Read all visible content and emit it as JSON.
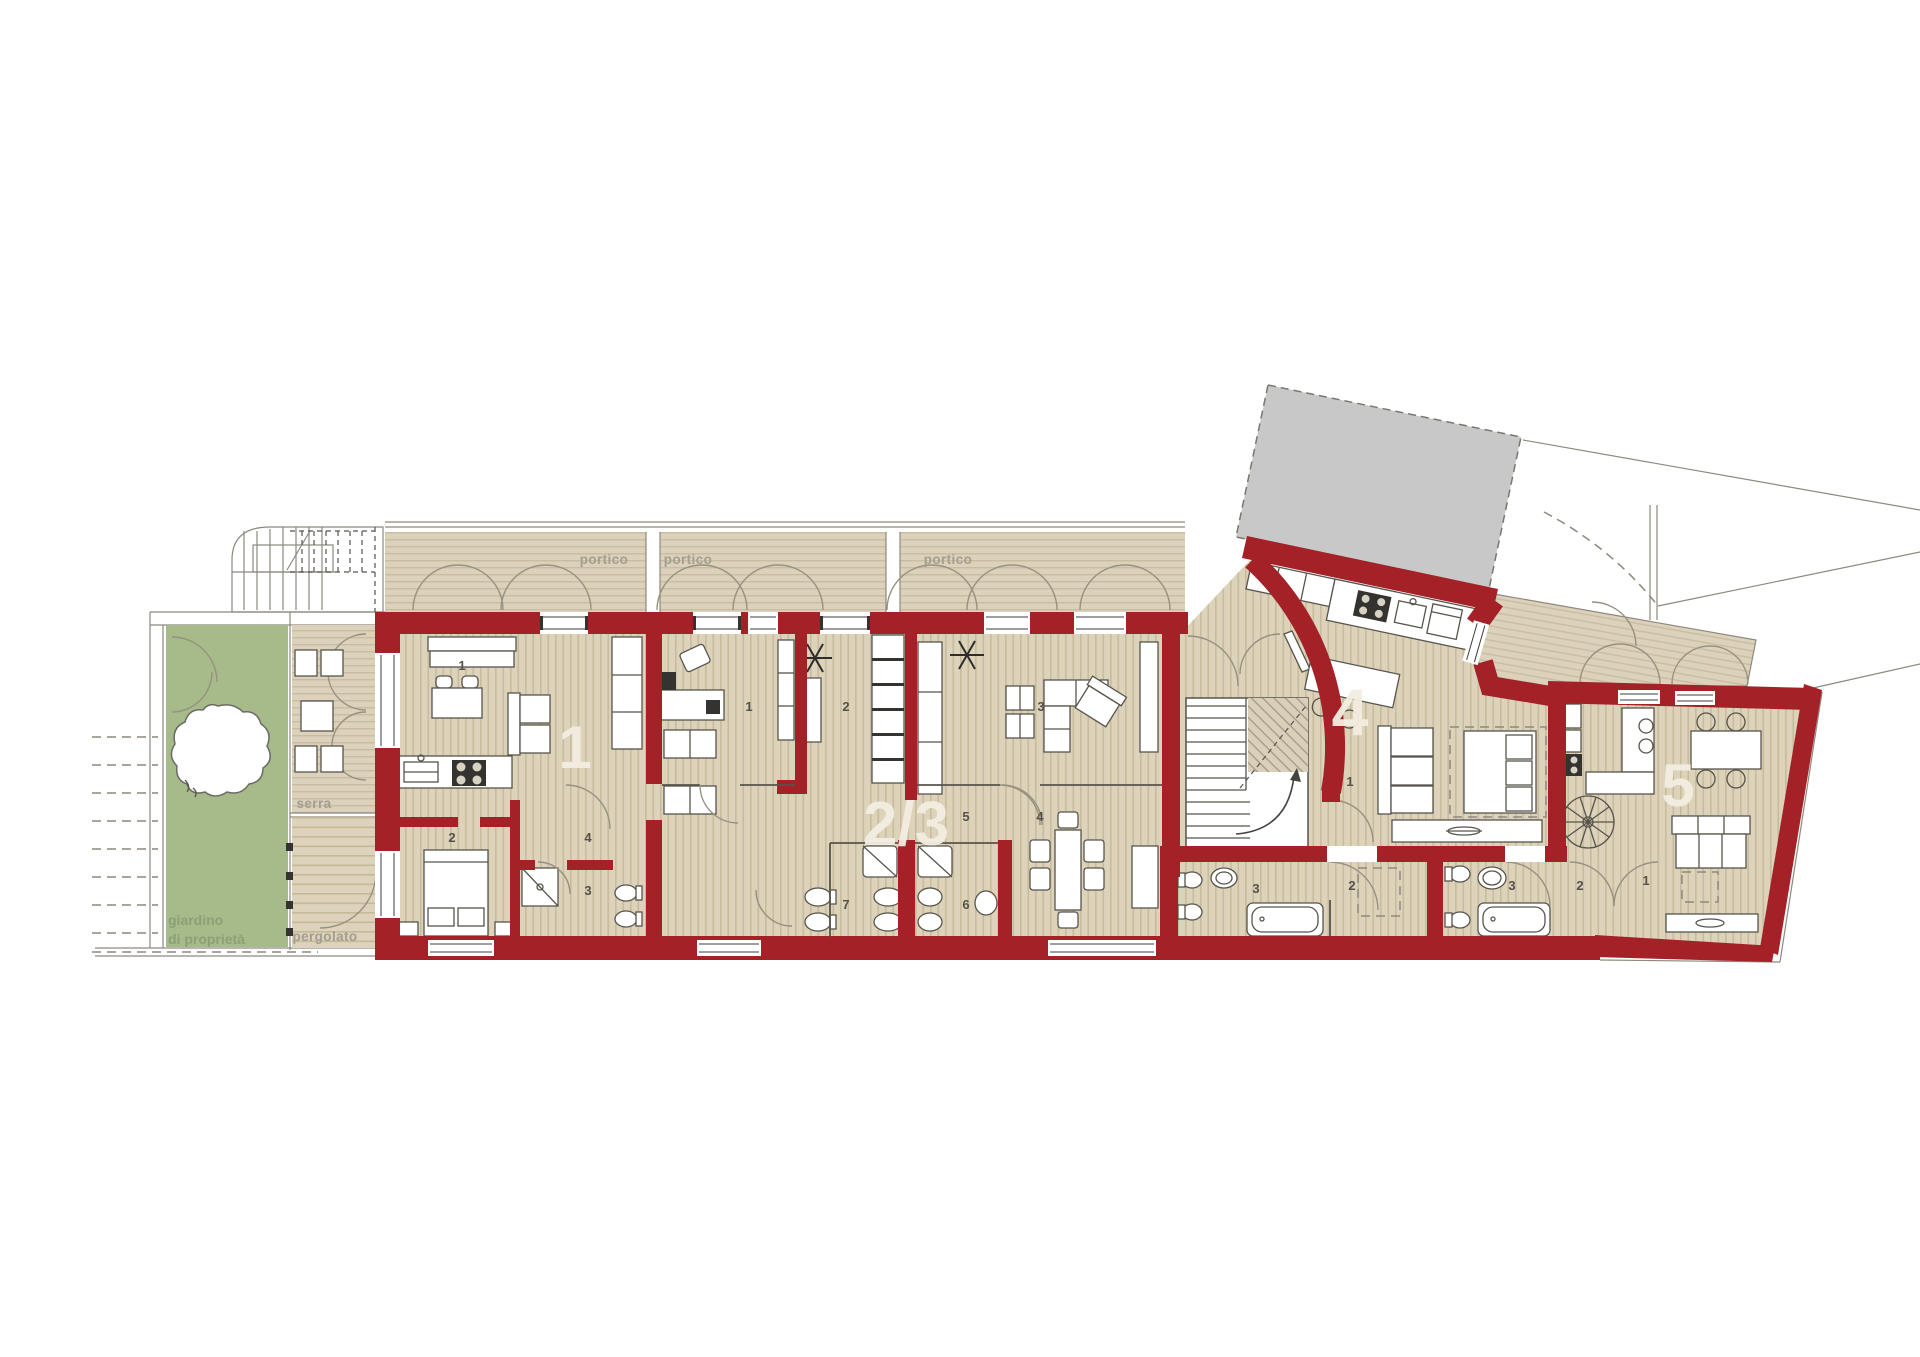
{
  "plan": {
    "site_labels": {
      "garden_line1": "giardino",
      "garden_line2": "di proprietà",
      "pergolato": "pergolato",
      "serra": "serra",
      "portico1": "portico",
      "portico2": "portico",
      "portico3": "portico"
    },
    "units": [
      {
        "label": "1",
        "rooms": [
          "1",
          "2",
          "3",
          "4"
        ]
      },
      {
        "label": "2/3",
        "rooms": [
          "1",
          "2",
          "3",
          "4",
          "5",
          "6",
          "7"
        ]
      },
      {
        "label": "4",
        "rooms": [
          "1",
          "2",
          "3"
        ]
      },
      {
        "label": "5",
        "rooms": [
          "1",
          "2",
          "3"
        ]
      }
    ],
    "colors": {
      "wall_red": "#a32127",
      "floor_beige": "#ddd2ba",
      "floor_stripe": "#c8bb9e",
      "garden_green": "#a6ba8a",
      "existing_building_gray": "#c8c8c8",
      "area_label_gray": "#a39e90",
      "unit_number_white": "#f3eee1"
    }
  }
}
